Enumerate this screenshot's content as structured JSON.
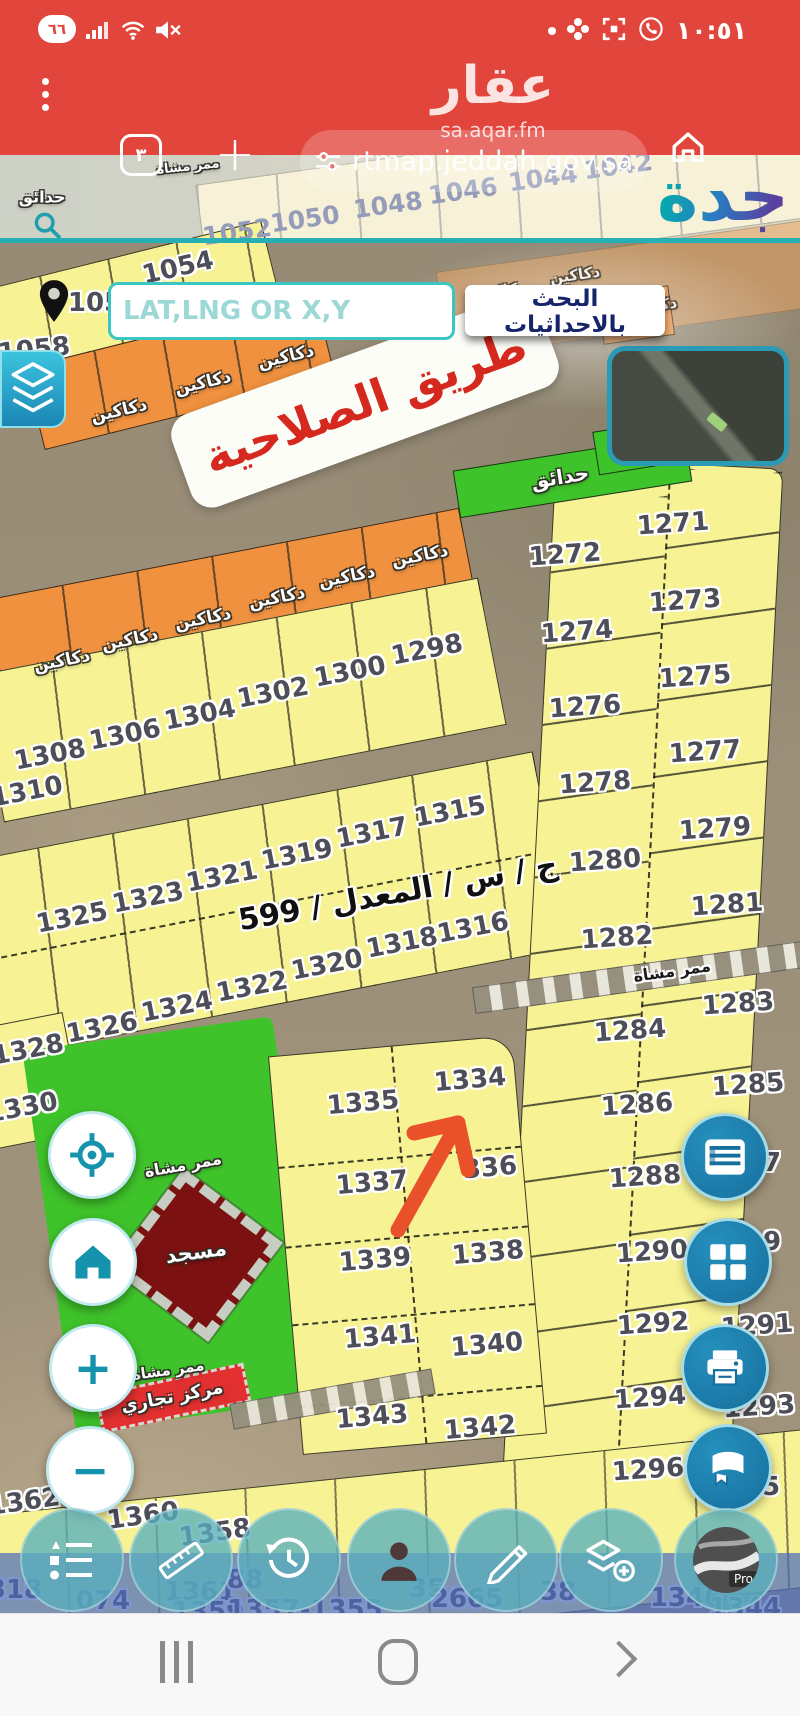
{
  "colors": {
    "chrome_red": "#e2453b",
    "teal_accent": "#28b0b4",
    "parcel_yellow": "#f7f394",
    "shops_orange": "#ef913f",
    "park_green": "#3fc32a",
    "mosque_red": "#7c1111",
    "button_blue": "#176f9e",
    "toolbar_teal": "rgba(88,174,188,0.78)",
    "strip_blue": "rgba(77,108,188,0.72)",
    "sign_red": "#d5281e"
  },
  "status_bar": {
    "battery_level": "٦٦",
    "time": "١٠:٥١"
  },
  "browser": {
    "tab_count": "٣",
    "url": "rtmap.jeddah.gov.sa"
  },
  "watermark": {
    "name": "عقار",
    "domain": "sa.aqar.fm"
  },
  "map": {
    "logo_text": "جدة",
    "search": {
      "placeholder": "LAT,LNG OR X,Y",
      "button_label": "البحث بالاحداثيات"
    },
    "road_sign": "طريق الصلاحية",
    "street_label": "ج / س / المعدل / 599",
    "pro_badge": "Pro",
    "parcel_labels": [
      {
        "t": "1052",
        "x": 237,
        "y": 232,
        "r": -8,
        "k": "pale"
      },
      {
        "t": "1050",
        "x": 305,
        "y": 219,
        "r": -8,
        "k": "pale"
      },
      {
        "t": "1048",
        "x": 388,
        "y": 205,
        "r": -8,
        "k": "pale"
      },
      {
        "t": "1046",
        "x": 463,
        "y": 191,
        "r": -8,
        "k": "pale"
      },
      {
        "t": "1044",
        "x": 543,
        "y": 178,
        "r": -8,
        "k": "pale"
      },
      {
        "t": "1042",
        "x": 618,
        "y": 166,
        "r": -8,
        "k": "pale"
      },
      {
        "t": "1054",
        "x": 178,
        "y": 268,
        "r": -13
      },
      {
        "t": "105",
        "x": 95,
        "y": 303,
        "r": 0
      },
      {
        "t": "1058",
        "x": 34,
        "y": 350,
        "r": -6
      },
      {
        "t": "1298",
        "x": 427,
        "y": 650,
        "r": -11
      },
      {
        "t": "1300",
        "x": 350,
        "y": 672,
        "r": -11
      },
      {
        "t": "1302",
        "x": 273,
        "y": 693,
        "r": -11
      },
      {
        "t": "1304",
        "x": 200,
        "y": 715,
        "r": -11
      },
      {
        "t": "1306",
        "x": 125,
        "y": 735,
        "r": -11
      },
      {
        "t": "1308",
        "x": 50,
        "y": 755,
        "r": -11
      },
      {
        "t": "1310",
        "x": 27,
        "y": 792,
        "r": -11
      },
      {
        "t": "1315",
        "x": 450,
        "y": 812,
        "r": -11
      },
      {
        "t": "1317",
        "x": 372,
        "y": 833,
        "r": -11
      },
      {
        "t": "1319",
        "x": 297,
        "y": 855,
        "r": -11
      },
      {
        "t": "1321",
        "x": 222,
        "y": 877,
        "r": -11
      },
      {
        "t": "1323",
        "x": 148,
        "y": 898,
        "r": -11
      },
      {
        "t": "1325",
        "x": 72,
        "y": 918,
        "r": -11
      },
      {
        "t": "1316",
        "x": 473,
        "y": 928,
        "r": -11
      },
      {
        "t": "1318",
        "x": 402,
        "y": 943,
        "r": -11
      },
      {
        "t": "1320",
        "x": 327,
        "y": 965,
        "r": -11
      },
      {
        "t": "1322",
        "x": 252,
        "y": 987,
        "r": -11
      },
      {
        "t": "1324",
        "x": 177,
        "y": 1007,
        "r": -11
      },
      {
        "t": "1326",
        "x": 102,
        "y": 1028,
        "r": -11
      },
      {
        "t": "1328",
        "x": 28,
        "y": 1050,
        "r": -11
      },
      {
        "t": "1330",
        "x": 22,
        "y": 1108,
        "r": -11
      },
      {
        "t": "1334",
        "x": 470,
        "y": 1080,
        "r": -5
      },
      {
        "t": "1335",
        "x": 363,
        "y": 1103,
        "r": -5
      },
      {
        "t": "336",
        "x": 490,
        "y": 1168,
        "r": -5
      },
      {
        "t": "1337",
        "x": 372,
        "y": 1183,
        "r": -5
      },
      {
        "t": "1338",
        "x": 488,
        "y": 1253,
        "r": -5
      },
      {
        "t": "1339",
        "x": 375,
        "y": 1260,
        "r": -5
      },
      {
        "t": "1340",
        "x": 487,
        "y": 1345,
        "r": -5
      },
      {
        "t": "1341",
        "x": 380,
        "y": 1337,
        "r": -5
      },
      {
        "t": "1343",
        "x": 372,
        "y": 1417,
        "r": -5
      },
      {
        "t": "1342",
        "x": 480,
        "y": 1428,
        "r": -5
      },
      {
        "t": "1272",
        "x": 565,
        "y": 555,
        "r": -4
      },
      {
        "t": "1274",
        "x": 577,
        "y": 632,
        "r": -4
      },
      {
        "t": "1276",
        "x": 585,
        "y": 707,
        "r": -4
      },
      {
        "t": "1278",
        "x": 595,
        "y": 783,
        "r": -4
      },
      {
        "t": "1280",
        "x": 605,
        "y": 861,
        "r": -4
      },
      {
        "t": "1282",
        "x": 617,
        "y": 938,
        "r": -4
      },
      {
        "t": "1284",
        "x": 630,
        "y": 1031,
        "r": -4
      },
      {
        "t": "1286",
        "x": 637,
        "y": 1105,
        "r": -4
      },
      {
        "t": "1288",
        "x": 645,
        "y": 1177,
        "r": -4
      },
      {
        "t": "1290",
        "x": 652,
        "y": 1252,
        "r": -4
      },
      {
        "t": "1292",
        "x": 653,
        "y": 1324,
        "r": -4
      },
      {
        "t": "1294",
        "x": 650,
        "y": 1398,
        "r": -4
      },
      {
        "t": "1296",
        "x": 648,
        "y": 1470,
        "r": -4
      },
      {
        "t": "1271",
        "x": 673,
        "y": 524,
        "r": -4
      },
      {
        "t": "1273",
        "x": 685,
        "y": 601,
        "r": -4
      },
      {
        "t": "1275",
        "x": 695,
        "y": 677,
        "r": -4
      },
      {
        "t": "1277",
        "x": 705,
        "y": 752,
        "r": -4
      },
      {
        "t": "1279",
        "x": 715,
        "y": 829,
        "r": -4
      },
      {
        "t": "1281",
        "x": 727,
        "y": 905,
        "r": -4
      },
      {
        "t": "1283",
        "x": 738,
        "y": 1004,
        "r": -4
      },
      {
        "t": "1285",
        "x": 748,
        "y": 1085,
        "r": -4
      },
      {
        "t": "7",
        "x": 772,
        "y": 1163,
        "r": 0
      },
      {
        "t": "9",
        "x": 772,
        "y": 1242,
        "r": 0
      },
      {
        "t": "1291",
        "x": 757,
        "y": 1326,
        "r": -4
      },
      {
        "t": "1293",
        "x": 759,
        "y": 1407,
        "r": -4
      },
      {
        "t": "5",
        "x": 771,
        "y": 1487,
        "r": 0
      },
      {
        "t": "1362",
        "x": 24,
        "y": 1502,
        "r": -8
      },
      {
        "t": "1360",
        "x": 143,
        "y": 1516,
        "r": -8
      },
      {
        "t": "1358",
        "x": 215,
        "y": 1533,
        "r": -8
      }
    ],
    "arabic_labels": [
      {
        "t": "حدائق",
        "x": 42,
        "y": 197,
        "r": 0,
        "s": 16,
        "k": ""
      },
      {
        "t": "ممر مشاة",
        "x": 188,
        "y": 167,
        "r": -6,
        "s": 13,
        "k": ""
      },
      {
        "t": "دكاكين",
        "x": 500,
        "y": 291,
        "r": -8,
        "s": 15,
        "k": "wp"
      },
      {
        "t": "دكاكين",
        "x": 575,
        "y": 275,
        "r": -8,
        "s": 15,
        "k": "wp"
      },
      {
        "t": "دكاكين",
        "x": 652,
        "y": 306,
        "r": -8,
        "s": 15,
        "k": "wp"
      },
      {
        "t": "دكاكين",
        "x": 286,
        "y": 357,
        "r": -13,
        "s": 17,
        "k": ""
      },
      {
        "t": "دكاكين",
        "x": 203,
        "y": 383,
        "r": -13,
        "s": 17,
        "k": ""
      },
      {
        "t": "دكاكين",
        "x": 119,
        "y": 411,
        "r": -13,
        "s": 17,
        "k": ""
      },
      {
        "t": "دكاكين",
        "x": 420,
        "y": 556,
        "r": -11,
        "s": 17,
        "k": ""
      },
      {
        "t": "دكاكين",
        "x": 347,
        "y": 577,
        "r": -11,
        "s": 17,
        "k": ""
      },
      {
        "t": "دكاكين",
        "x": 277,
        "y": 598,
        "r": -11,
        "s": 17,
        "k": ""
      },
      {
        "t": "دكاكين",
        "x": 203,
        "y": 619,
        "r": -11,
        "s": 17,
        "k": ""
      },
      {
        "t": "دكاكين",
        "x": 130,
        "y": 640,
        "r": -11,
        "s": 17,
        "k": ""
      },
      {
        "t": "دكاكين",
        "x": 62,
        "y": 661,
        "r": -11,
        "s": 17,
        "k": ""
      },
      {
        "t": "حدائق",
        "x": 560,
        "y": 477,
        "r": -9,
        "s": 20,
        "k": ""
      },
      {
        "t": "حدائق",
        "x": 641,
        "y": 449,
        "r": -9,
        "s": 15,
        "k": ""
      },
      {
        "t": "ممر مشاة",
        "x": 672,
        "y": 971,
        "r": -8,
        "s": 16,
        "k": "d"
      },
      {
        "t": "ممر مشاة",
        "x": 183,
        "y": 1165,
        "r": -10,
        "s": 16,
        "k": ""
      },
      {
        "t": "مسجد",
        "x": 196,
        "y": 1252,
        "r": -8,
        "s": 21,
        "k": ""
      },
      {
        "t": "ممر مشاة",
        "x": 168,
        "y": 1370,
        "r": -8,
        "s": 15,
        "k": ""
      },
      {
        "t": "مركز تجاري",
        "x": 172,
        "y": 1397,
        "r": -11,
        "s": 18,
        "k": ""
      }
    ],
    "bottom_numbers": [
      {
        "t": "318",
        "x": 15,
        "y": 1590
      },
      {
        "t": "074",
        "x": 103,
        "y": 1601
      },
      {
        "t": "1361",
        "x": 200,
        "y": 1592
      },
      {
        "t": "88",
        "x": 245,
        "y": 1580
      },
      {
        "t": "1359",
        "x": 208,
        "y": 1612
      },
      {
        "t": "1357-1355",
        "x": 305,
        "y": 1610
      },
      {
        "t": "35",
        "x": 427,
        "y": 1589
      },
      {
        "t": "2665",
        "x": 467,
        "y": 1599
      },
      {
        "t": "38",
        "x": 558,
        "y": 1592
      },
      {
        "t": "1346",
        "x": 686,
        "y": 1598
      },
      {
        "t": "1344",
        "x": 745,
        "y": 1608
      }
    ]
  }
}
